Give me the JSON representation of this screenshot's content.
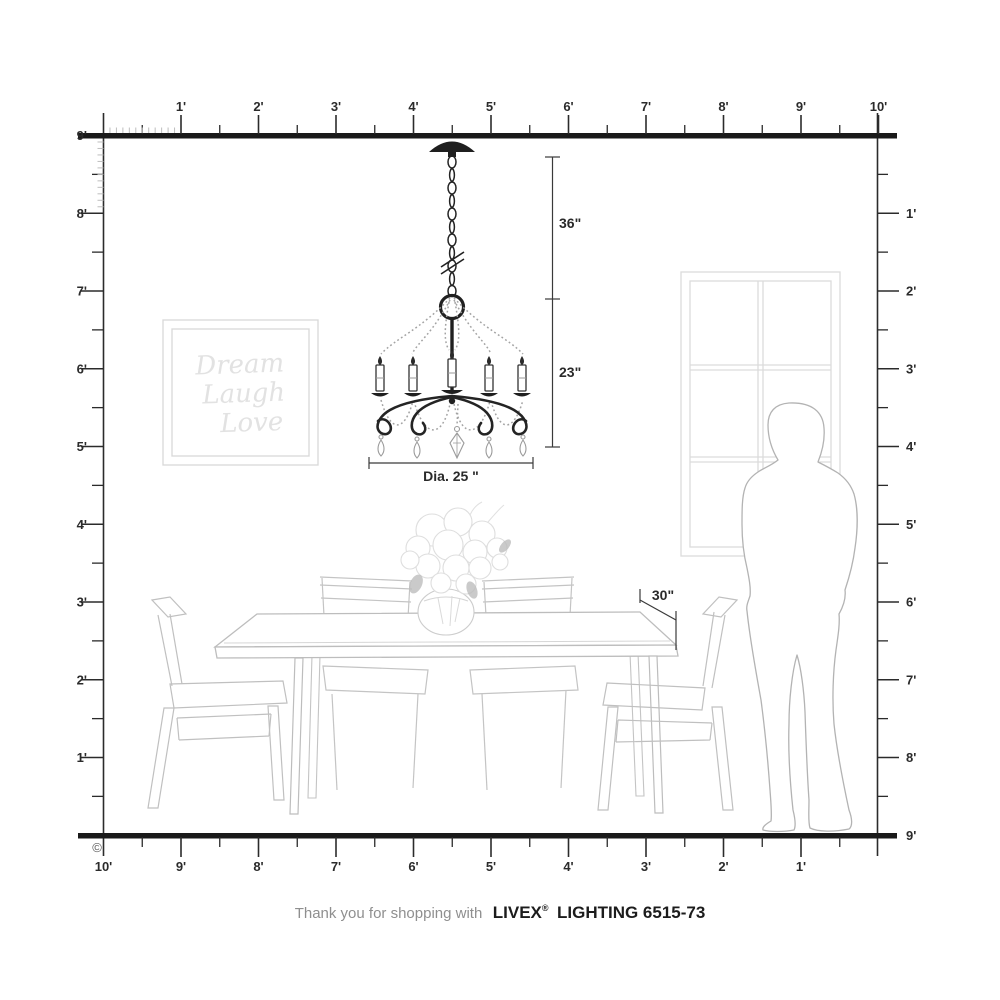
{
  "annotations": {
    "chain_length": "36\"",
    "fixture_height": "23\"",
    "fixture_diameter": "Dia. 25 \"",
    "table_depth": "30\""
  },
  "rulers": {
    "top": {
      "labels": [
        "1'",
        "2'",
        "3'",
        "4'",
        "5'",
        "6'",
        "7'",
        "8'",
        "9'",
        "10'"
      ]
    },
    "left": {
      "labels": [
        "9'",
        "8'",
        "7'",
        "6'",
        "5'",
        "4'",
        "3'",
        "2'",
        "1'"
      ]
    },
    "right": {
      "labels": [
        "1'",
        "2'",
        "3'",
        "4'",
        "5'",
        "6'",
        "7'",
        "8'",
        "9'"
      ]
    },
    "bottom": {
      "labels": [
        "10'",
        "9'",
        "8'",
        "7'",
        "6'",
        "5'",
        "4'",
        "3'",
        "2'",
        "1'"
      ]
    }
  },
  "wall_art": {
    "line1": "Dream",
    "line2": "Laugh",
    "line3": "Love"
  },
  "footer": {
    "message": "Thank you for shopping with",
    "brand": "LIVEX",
    "registered": "®",
    "product": "LIGHTING 6515-73"
  },
  "copyright": "©",
  "colors": {
    "ink": "#1a1a1a",
    "sketch": "#c0c0c0",
    "faint_sketch": "#dedede"
  }
}
